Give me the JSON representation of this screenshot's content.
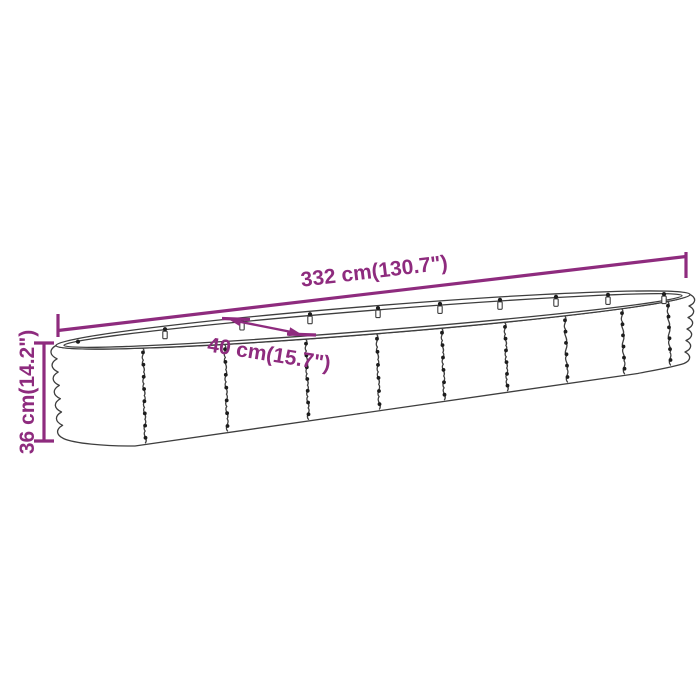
{
  "diagram": {
    "background": "#FFFFFF",
    "colors": {
      "dimension_accent": "#8E2B7E",
      "linework": "#3E3E3E",
      "fastener": "#1C1C1C"
    },
    "dimensions": {
      "length": {
        "label": "332 cm(130.7\")",
        "cm": "332",
        "inches": "130.7"
      },
      "width": {
        "label": "40 cm(15.7\")",
        "cm": "40",
        "inches": "15.7"
      },
      "height": {
        "label": "36 cm(14.2\")",
        "cm": "36",
        "inches": "14.2"
      }
    }
  }
}
